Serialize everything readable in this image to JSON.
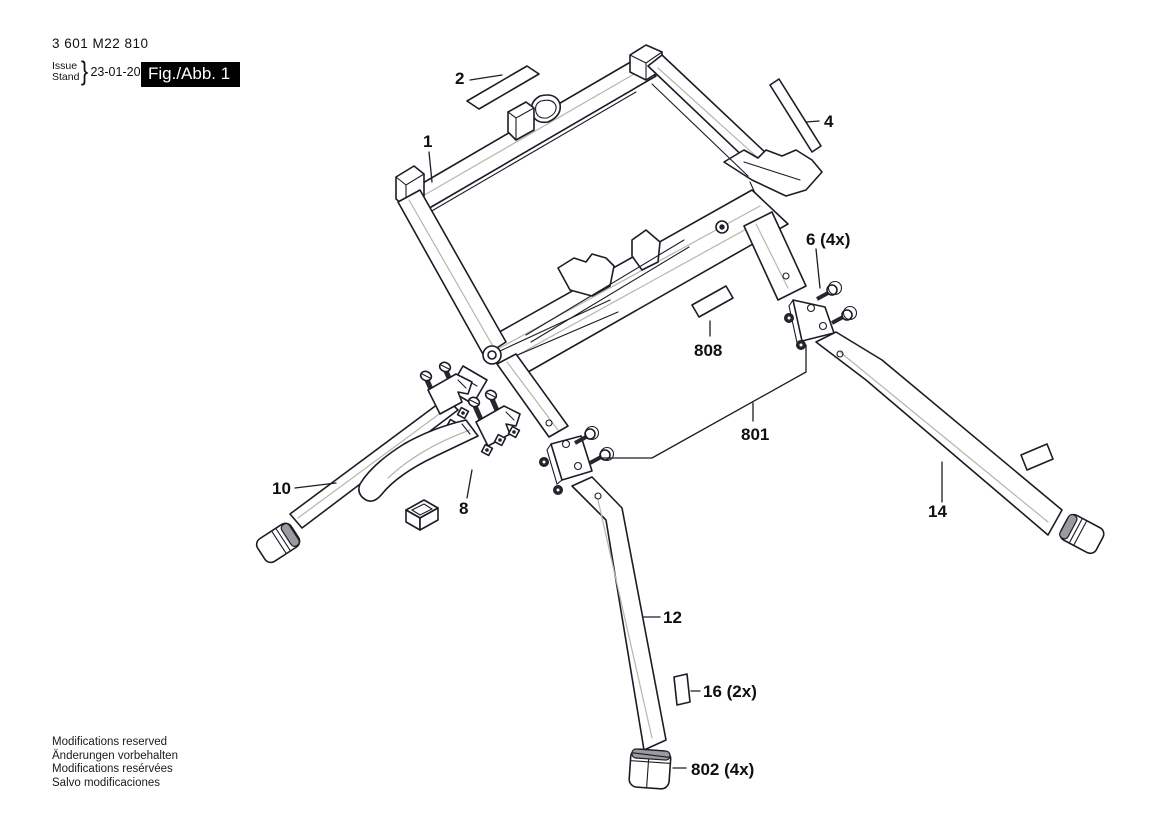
{
  "header": {
    "part_number": "3 601 M22 810",
    "issue_label": "Issue",
    "stand_label": "Stand",
    "brace": "}",
    "date": "23-01-20",
    "figure_label": "Fig./Abb. 1"
  },
  "footer": {
    "lines": [
      "Modifications reserved",
      "Änderungen vorbehalten",
      "Modifications resérvées",
      "Salvo modificaciones"
    ]
  },
  "drawing": {
    "description": "Exploded view of folding saw stand with frame, legs, brackets, screws, feet and labels",
    "callouts": [
      {
        "text": "1"
      },
      {
        "text": "2"
      },
      {
        "text": "4"
      },
      {
        "text": "6 (4x)"
      },
      {
        "text": "8"
      },
      {
        "text": "10"
      },
      {
        "text": "12"
      },
      {
        "text": "14"
      },
      {
        "text": "16 (2x)"
      },
      {
        "text": "801"
      },
      {
        "text": "802 (4x)"
      },
      {
        "text": "808"
      }
    ],
    "colors": {
      "line": "#1c1c26",
      "highlight": "#b6b6a8",
      "figure_box_bg": "#000000",
      "figure_box_fg": "#ffffff"
    }
  }
}
